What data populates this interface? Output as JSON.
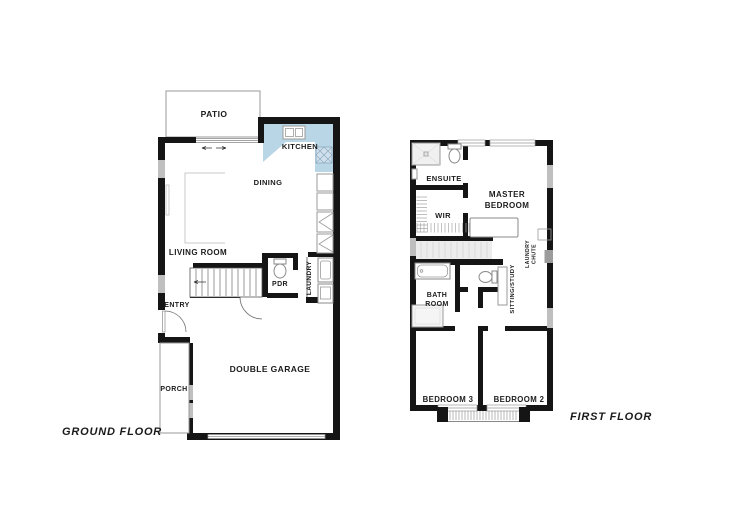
{
  "ground_floor": {
    "title": "GROUND FLOOR",
    "labels": {
      "patio": "PATIO",
      "kitchen": "KITCHEN",
      "dining": "DINING",
      "living_room": "LIVING ROOM",
      "entry": "ENTRY",
      "pdr": "PDR",
      "laundry": "LAUNDRY",
      "porch": "PORCH",
      "double_garage": "DOUBLE GARAGE"
    }
  },
  "first_floor": {
    "title": "FIRST FLOOR",
    "labels": {
      "ensuite": "ENSUITE",
      "wir": "WIR",
      "master_line1": "MASTER",
      "master_line2": "BEDROOM",
      "laundry_chute_line1": "LAUNDRY",
      "laundry_chute_line2": "CHUTE",
      "bath_line1": "BATH",
      "bath_line2": "ROOM",
      "sitting_study": "SITTING/STUDY",
      "bedroom3": "BEDROOM 3",
      "bedroom2": "BEDROOM 2"
    }
  },
  "colors": {
    "wall": "#151515",
    "window": "#bfbfbf",
    "kitchen_counter": "#b9d6e6",
    "stair_void": "#ececec"
  }
}
